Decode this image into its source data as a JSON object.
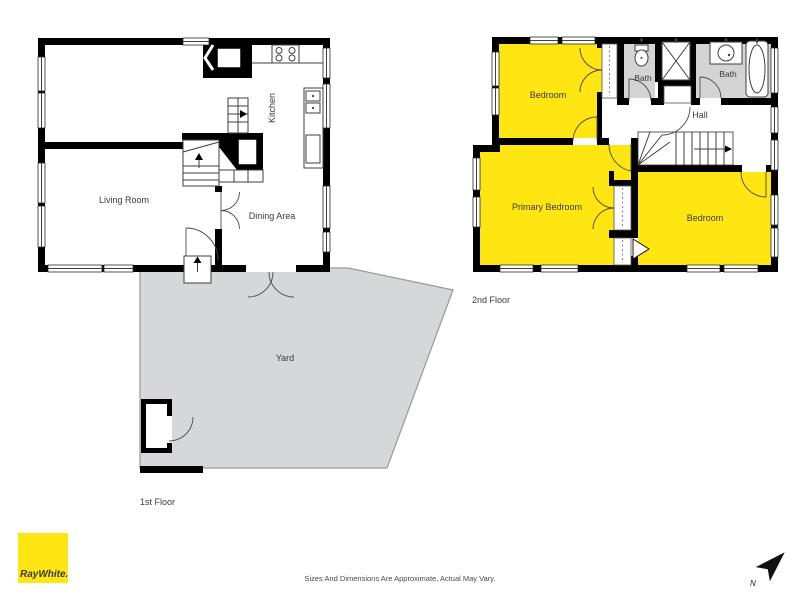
{
  "first_floor": {
    "floor_label": "1st Floor",
    "rooms": {
      "living_room": "Living Room",
      "kitchen": "Kitchen",
      "dining_area": "Dining Area",
      "yard": "Yard"
    }
  },
  "second_floor": {
    "floor_label": "2nd Floor",
    "rooms": {
      "bedroom_top": "Bedroom",
      "bath_left": "Bath",
      "bath_right": "Bath",
      "hall": "Hall",
      "primary_bedroom": "Primary Bedroom",
      "bedroom_bottom": "Bedroom"
    }
  },
  "branding": {
    "logo_text": "RayWhite."
  },
  "compass": {
    "north_label": "N"
  },
  "footer": {
    "disclaimer": "Sizes And Dimensions Are Approximate, Actual May Vary."
  },
  "colors": {
    "room_yellow": "#FFE512",
    "bath_gray": "#D4D4D4",
    "yard_gray": "#D5D7D8",
    "wall_black": "#000000"
  }
}
